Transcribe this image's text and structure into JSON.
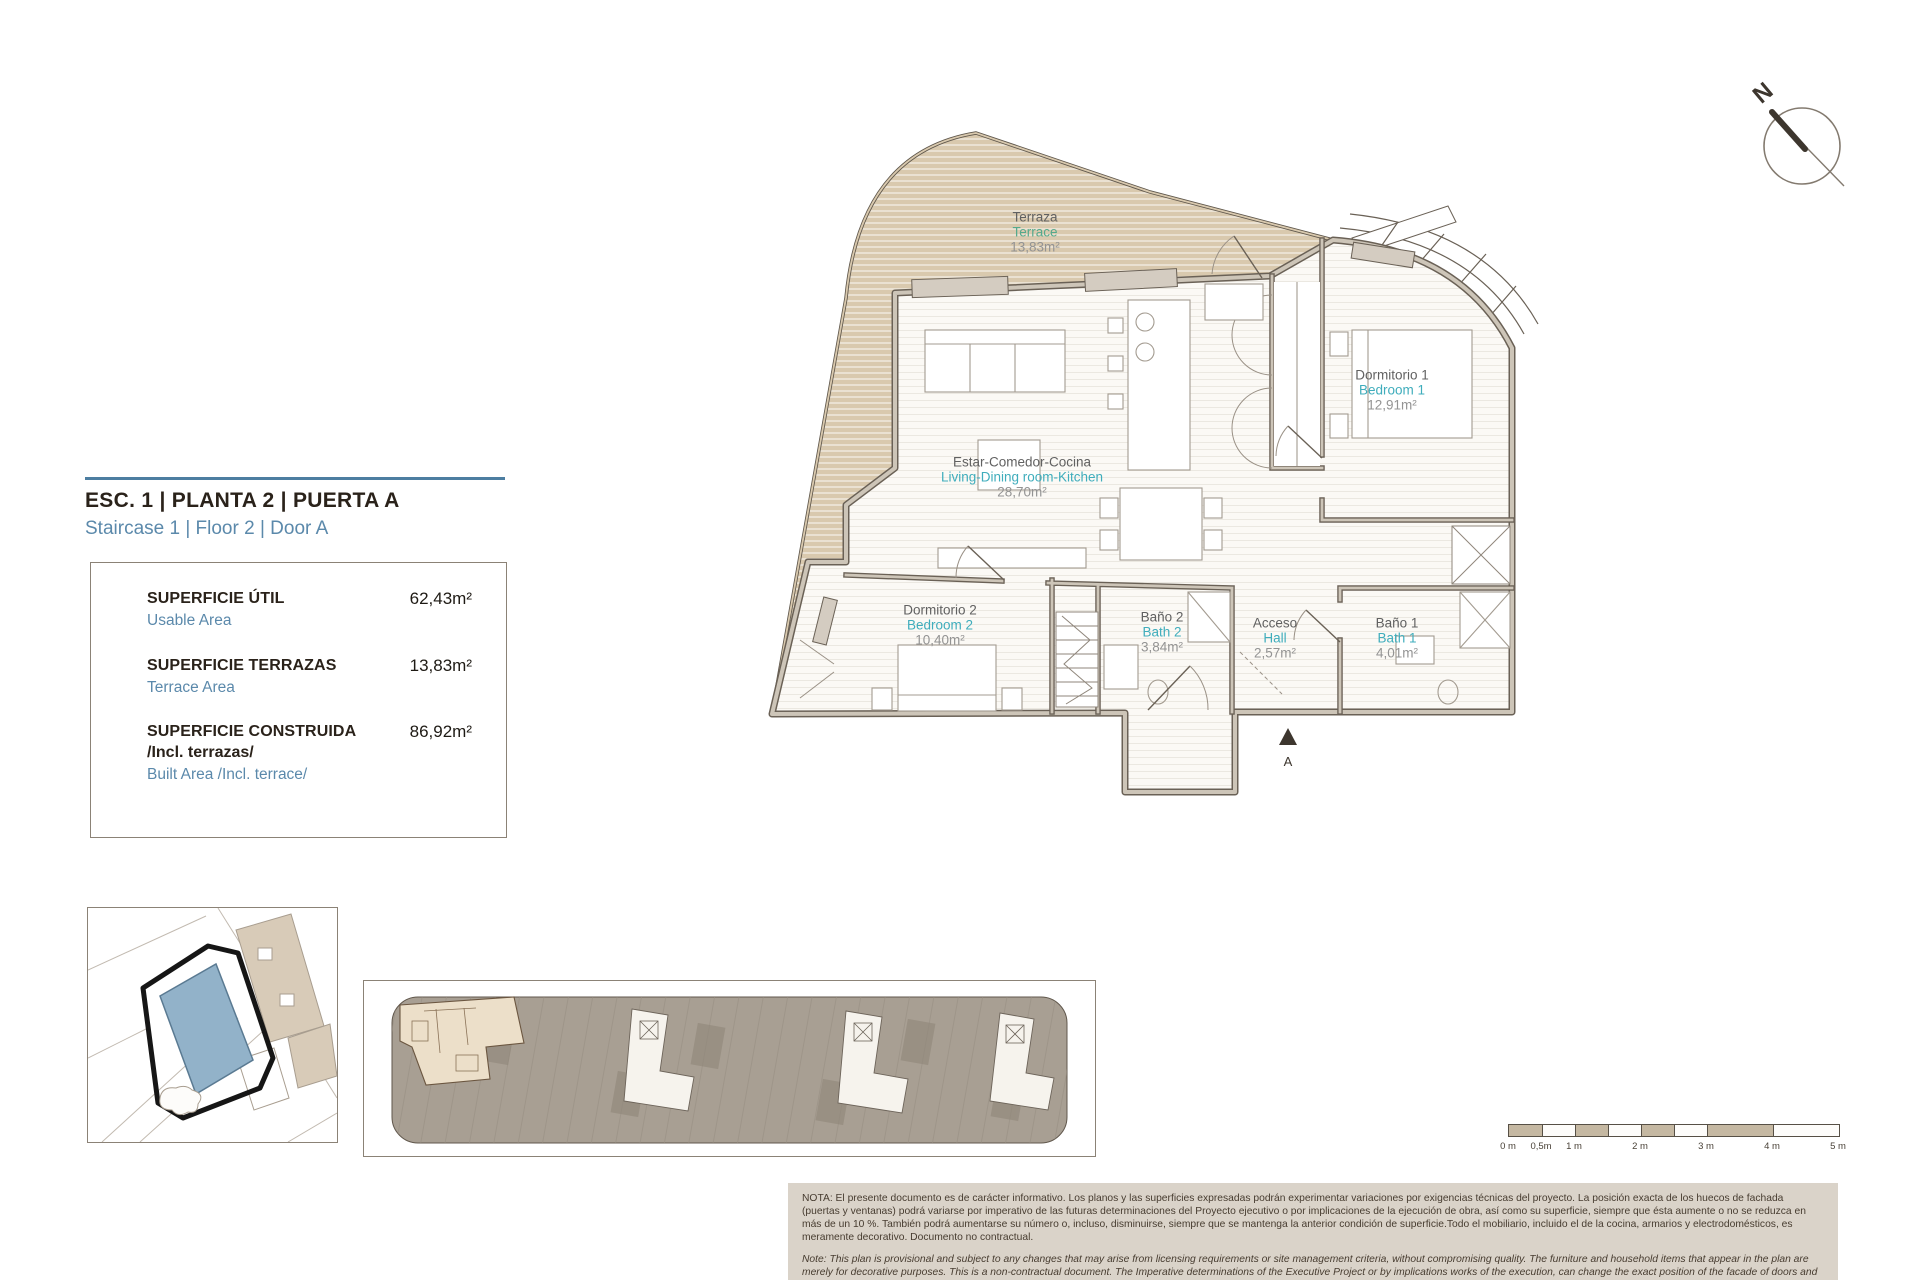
{
  "header": {
    "title": "ESC. 1 | PLANTA 2 | PUERTA A",
    "subtitle": "Staircase 1 | Floor 2 | Door A",
    "accent_color": "#4d7ea1"
  },
  "area_table": {
    "rows": [
      {
        "label_es": "SUPERFICIE ÚTIL",
        "label_en": "Usable Area",
        "value": "62,43m²"
      },
      {
        "label_es": "SUPERFICIE TERRAZAS",
        "label_en": "Terrace Area",
        "value": "13,83m²"
      },
      {
        "label_es": "SUPERFICIE CONSTRUIDA",
        "label_es_2": "/Incl. terrazas/",
        "label_en": "Built Area /Incl. terrace/",
        "value": "86,92m²"
      }
    ]
  },
  "plan": {
    "north_label": "N",
    "entrance_label": "A",
    "colors": {
      "terrace_fill": "#d9c9ae",
      "wall_dark": "#6a6156",
      "wall_light": "#cdc5b8",
      "label_es": "#616161",
      "label_en": "#3fadbc",
      "label_en_terrace": "#55a98c",
      "label_area": "#939393"
    },
    "rooms": [
      {
        "name_es": "Terraza",
        "name_en": "Terrace",
        "area": "13,83m²"
      },
      {
        "name_es": "Dormitorio 1",
        "name_en": "Bedroom 1",
        "area": "12,91m²"
      },
      {
        "name_es": "Estar-Comedor-Cocina",
        "name_en": "Living-Dining room-Kitchen",
        "area": "28,70m²"
      },
      {
        "name_es": "Dormitorio 2",
        "name_en": "Bedroom 2",
        "area": "10,40m²"
      },
      {
        "name_es": "Baño 2",
        "name_en": "Bath 2",
        "area": "3,84m²"
      },
      {
        "name_es": "Acceso",
        "name_en": "Hall",
        "area": "2,57m²"
      },
      {
        "name_es": "Baño 1",
        "name_en": "Bath 1",
        "area": "4,01m²"
      }
    ]
  },
  "scale_bar": {
    "labels": [
      "0 m",
      "0,5m",
      "1 m",
      "2 m",
      "3 m",
      "4 m",
      "5 m"
    ]
  },
  "notes": {
    "es": "NOTA: El presente documento es de carácter informativo. Los planos y las superficies expresadas podrán experimentar variaciones por exigencias técnicas del proyecto. La posición exacta de los huecos de fachada (puertas y ventanas) podrá variarse por imperativo de las futuras determinaciones del Proyecto ejecutivo o por implicaciones de la ejecución de obra, así como su superficie, siempre que ésta aumente o no se reduzca en más de un 10 %. También podrá aumentarse su número o, incluso, disminuirse, siempre que se mantenga la anterior condición de superficie.Todo el mobiliario, incluido el de la cocina, armarios y electrodomésticos, es meramente decorativo. Documento no contractual.",
    "en": "Note: This plan is provisional and subject to any changes that may arise from licensing requirements or site management criteria, without compromising quality. The furniture and household items that appear in the plan are merely for decorative purposes. This is a non-contractual document. The Imperative determinations of the Executive Project or by implications works of the execution, can change the exact position of the facade of doors and windows, as well the surface area may also be increased or even decrease not more than a 10%.",
    "version": "V.1_JUN-25"
  }
}
